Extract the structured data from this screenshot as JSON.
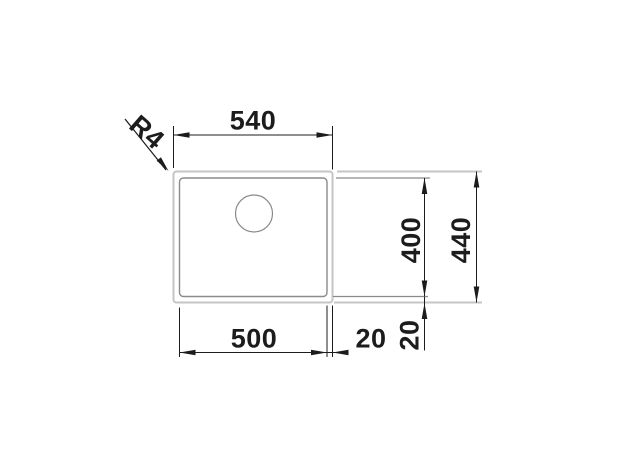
{
  "diagram": {
    "kind": "technical-dimension-drawing",
    "subject": "undermount-sink-top-view",
    "labels": {
      "outer_width": "540",
      "corner_radius": "R4",
      "bowl_height": "400",
      "outer_height": "440",
      "bowl_width": "500",
      "rim_offset_right": "20",
      "rim_offset_bottom": "20"
    },
    "colors": {
      "background": "#ffffff",
      "dimension": "#1c1c1c",
      "rim_outline": "#c5c5c5",
      "bowl_outline": "#8a8a8a"
    }
  }
}
